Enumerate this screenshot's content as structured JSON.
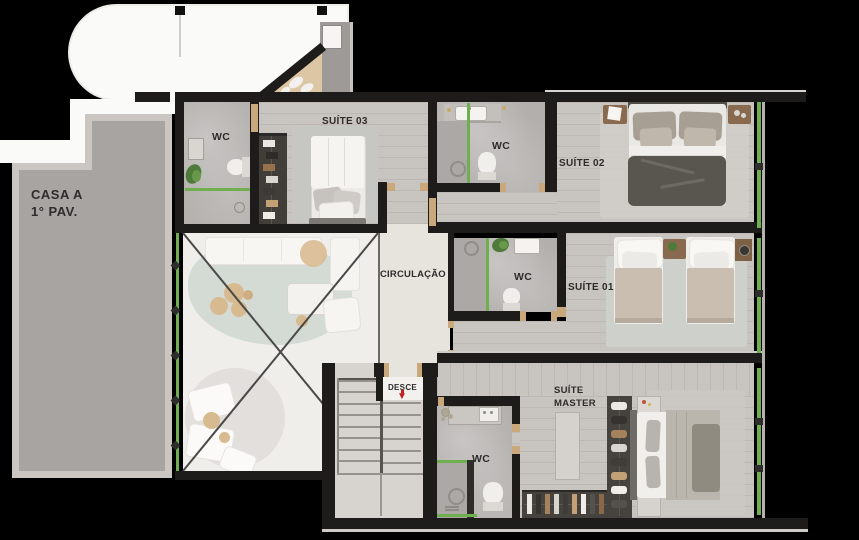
{
  "title": {
    "line1": "CASA A",
    "line2": "1° PAV."
  },
  "rooms": {
    "suite03": {
      "name": "SUÍTE 03",
      "wc": "WC"
    },
    "suite02": {
      "name": "SUÍTE 02",
      "wc": "WC"
    },
    "suite01": {
      "name": "SUÍTE 01",
      "wc": "WC"
    },
    "suite_master": {
      "name_line1": "SUÍTE",
      "name_line2": "MASTER",
      "wc": "WC"
    },
    "circulation": {
      "name": "CIRCULAÇÃO"
    },
    "stairs": {
      "name": "DESCE",
      "direction_icon": "▼"
    }
  },
  "colors": {
    "background": "#000000",
    "walls": "#1d1c1a",
    "roof": "#fafaf9",
    "terrace": "#a8a4a1",
    "terrace_border": "#cbc6c2",
    "wood_floor": "#c8c4c0",
    "bathroom_floor": "#b2afac",
    "circulation_floor": "#e7e3dd",
    "accent_green": "#6faf4f",
    "door_frame_wood": "#c9a87c",
    "stairs_arrow_red": "#c3201f",
    "label_text": "#2e2c2a"
  }
}
